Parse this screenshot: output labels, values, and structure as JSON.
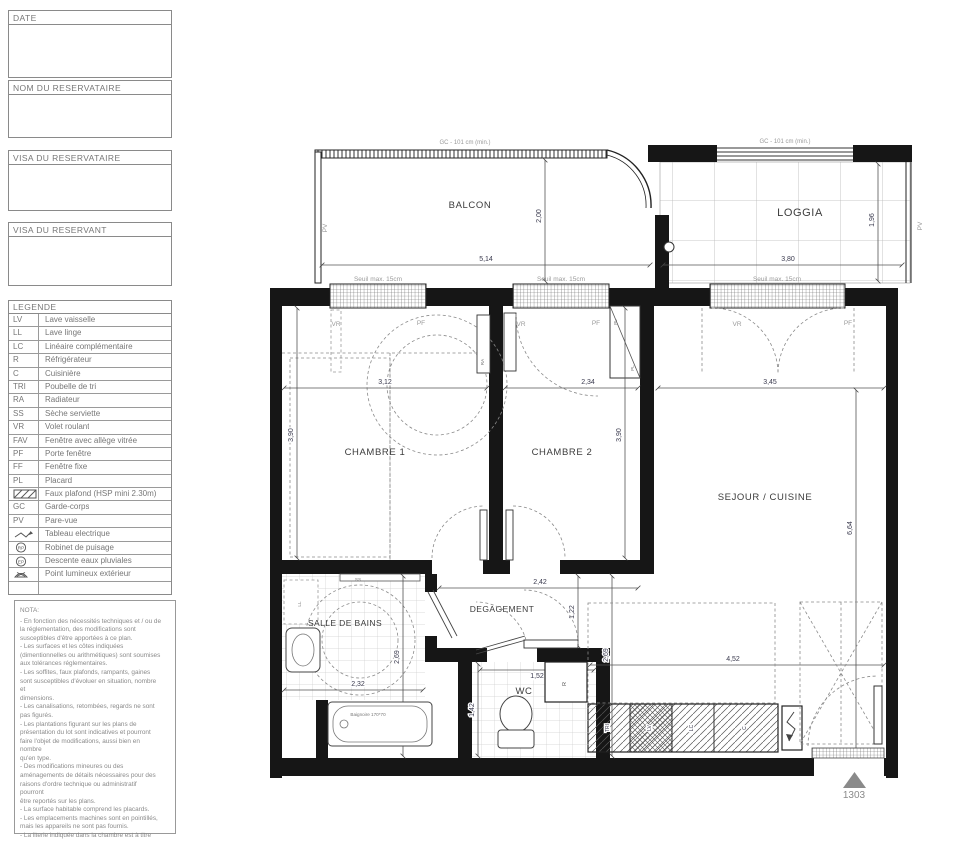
{
  "sidebar": {
    "boxes": [
      {
        "label": "DATE"
      },
      {
        "label": "NOM DU RESERVATAIRE"
      },
      {
        "label": "VISA DU RESERVATAIRE"
      },
      {
        "label": "VISA DU RESERVANT"
      }
    ],
    "legend": {
      "title": "LEGENDE",
      "rp_text": "RP",
      "ep_text": "EP",
      "items": [
        {
          "abbr": "LV",
          "label": "Lave vaisselle"
        },
        {
          "abbr": "LL",
          "label": "Lave linge"
        },
        {
          "abbr": "LC",
          "label": "Linéaire complémentaire"
        },
        {
          "abbr": "R",
          "label": "Réfrigérateur"
        },
        {
          "abbr": "C",
          "label": "Cuisinière"
        },
        {
          "abbr": "TRI",
          "label": "Poubelle de tri"
        },
        {
          "abbr": "RA",
          "label": "Radiateur"
        },
        {
          "abbr": "SS",
          "label": "Sèche serviette"
        },
        {
          "abbr": "VR",
          "label": "Volet roulant"
        },
        {
          "abbr": "FAV",
          "label": "Fenêtre avec allège vitrée"
        },
        {
          "abbr": "PF",
          "label": "Porte fenêtre"
        },
        {
          "abbr": "FF",
          "label": "Fenêtre fixe"
        },
        {
          "abbr": "PL",
          "label": "Placard"
        },
        {
          "abbr": "",
          "label": "Faux plafond (HSP mini 2.30m)"
        },
        {
          "abbr": "GC",
          "label": "Garde-corps"
        },
        {
          "abbr": "PV",
          "label": "Pare-vue"
        },
        {
          "abbr": "",
          "label": "Tableau electrique"
        },
        {
          "abbr": "",
          "label": "Robinet de puisage"
        },
        {
          "abbr": "",
          "label": "Descente eaux pluviales"
        },
        {
          "abbr": "",
          "label": "Point lumineux extérieur"
        }
      ]
    },
    "nota": {
      "title": "NOTA:",
      "body": "- En fonction des nécessités techniques et / ou de\nla réglementation, des modifications sont\nsusceptibles d'être apportées à ce plan.\n- Les surfaces et les côtes indiquées\n(dimentionnelles ou arithmétiques) sont soumises\naux tolérances réglementaires.\n- Les soffites, faux plafonds, rampants, gaines\nsont susceptibles d'évoluer en situation, nombre\net\ndimensions.\n- Les canalisations, retombées, regards ne sont\npas figurés.\n- Les plantations figurant sur les plans de\nprésentation du lot sont indicatives et pourront\nfaire l'objet de modifications, aussi bien en\nnombre\nqu'en type.\n- Des modifications mineures ou des\naménagements de détails nécessaires pour des\nraisons d'ordre technique ou administratif\npourront\nêtre reportés sur les plans.\n- La surface habitable comprend les placards.\n- Les emplacements machines sont en pointillés,\nmais les appareils ne sont pas fournis.\n- La literie indiquée dans la chambre est à titre"
    }
  },
  "plan": {
    "gc_label": "GC - 101 cm (min.)",
    "seuil": "Seuil max. 15cm",
    "lot": "1303",
    "balcon": {
      "name": "BALCON",
      "width": "5,14",
      "depth": "2,00",
      "pv": "PV"
    },
    "loggia": {
      "name": "LOGGIA",
      "width": "3,80",
      "depth": "1,96",
      "pv": "PV"
    },
    "chambre1": {
      "name": "CHAMBRE 1",
      "width": "3,12",
      "depth": "3,90",
      "vr": "VR",
      "pf": "PF",
      "ra": "RA"
    },
    "chambre2": {
      "name": "CHAMBRE 2",
      "width": "2,34",
      "depth": "3,90",
      "vr": "VR",
      "pf": "PF",
      "pl": "PL"
    },
    "sejour": {
      "name": "SEJOUR / CUISINE",
      "width": "3,45",
      "depth": "6,64",
      "width2": "4,52",
      "depth2": "2,69",
      "vr": "VR",
      "pf": "PF"
    },
    "sdb": {
      "name": "SALLE DE BAINS",
      "width": "2,32",
      "depth": "2,69",
      "ss": "SS",
      "ll": "LL",
      "tub": "Baignoire 170*70"
    },
    "degagement": {
      "name": "DEGAGEMENT",
      "width": "2,42",
      "depth": "1,22"
    },
    "wc": {
      "name": "WC",
      "width": "1,52",
      "depth": "1,42",
      "r": "R"
    },
    "kitchen": {
      "cells": [
        "TRI",
        "LV",
        "LC",
        "C"
      ]
    }
  }
}
